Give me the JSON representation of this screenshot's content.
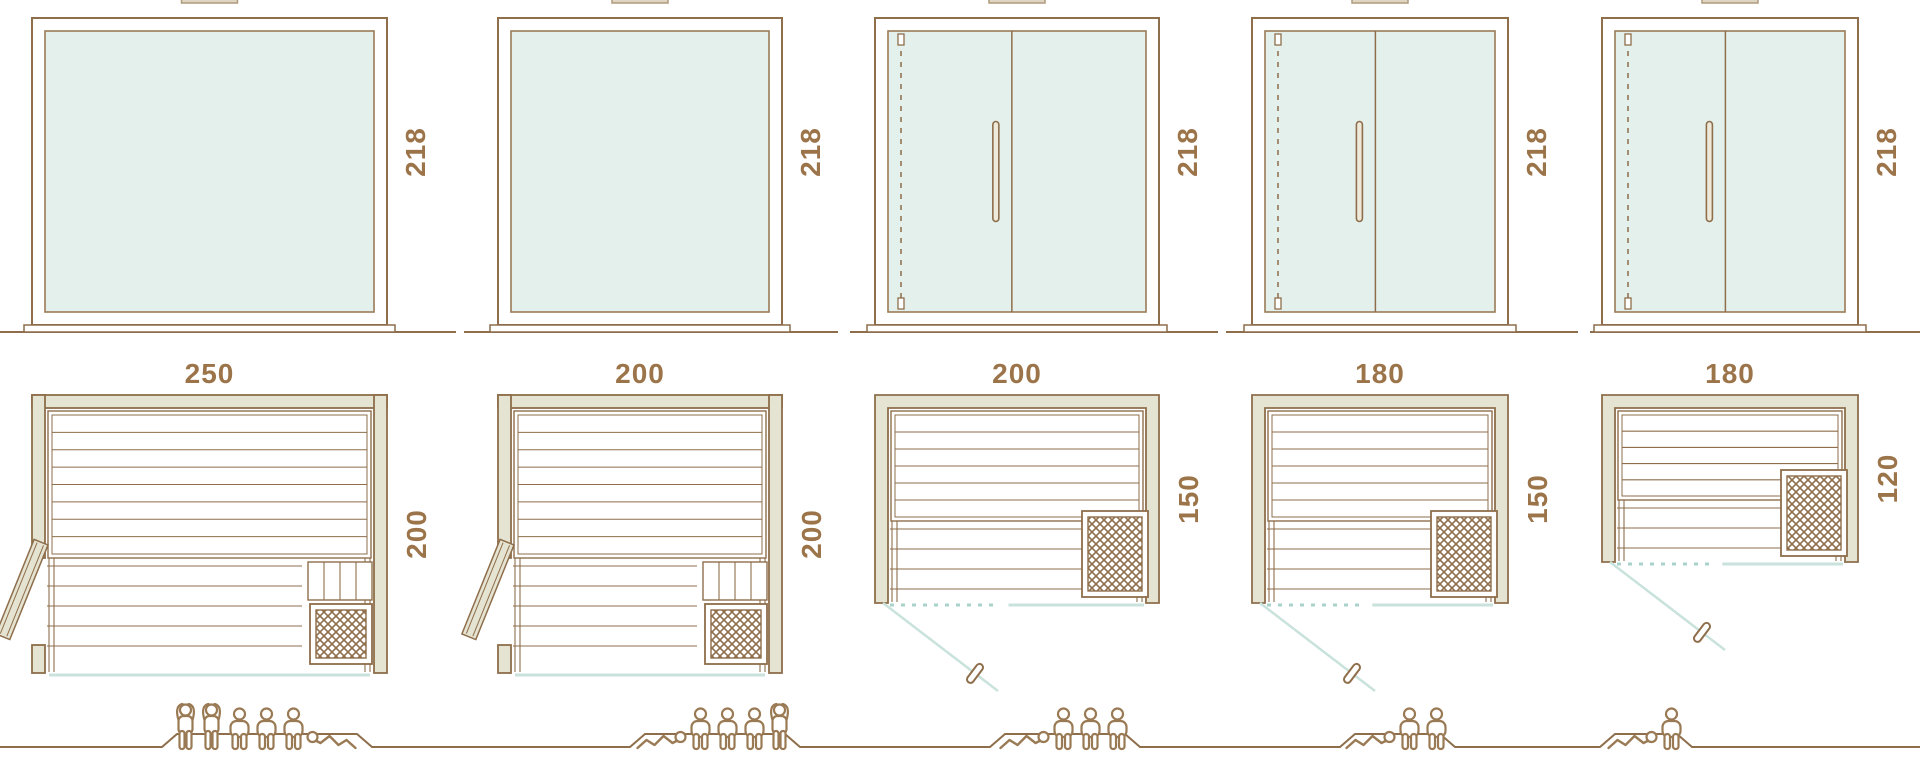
{
  "diagram_title": "sauna-size-comparison",
  "colors": {
    "line": "#8e6e4b",
    "text": "#9c744a",
    "glass_fill": "#e4f0ec",
    "glass_stroke": "#9b7b57",
    "wall_fill": "#e5e3d1",
    "teal_solid": "#c9e2dc",
    "teal_dash": "#a9d2cb",
    "people_line": "#9a7a54"
  },
  "models": [
    {
      "name": "sauna-250x200",
      "plan_width_label": "250",
      "plan_depth_label": "200",
      "elevation_height_label": "218",
      "front_type": "fixed-glass",
      "door": "hinged-side-door-left",
      "heater_position": "bottom-right",
      "capacity_total": 6,
      "capacity_icons": [
        "standing",
        "standing",
        "seated",
        "seated",
        "seated",
        "reclining"
      ]
    },
    {
      "name": "sauna-200x200",
      "plan_width_label": "200",
      "plan_depth_label": "200",
      "elevation_height_label": "218",
      "front_type": "fixed-glass",
      "door": "hinged-side-door-left",
      "heater_position": "bottom-right",
      "capacity_total": 5,
      "capacity_icons": [
        "reclining",
        "seated",
        "seated",
        "seated",
        "standing"
      ]
    },
    {
      "name": "sauna-200x150",
      "plan_width_label": "200",
      "plan_depth_label": "150",
      "elevation_height_label": "218",
      "front_type": "double-glass-door",
      "door": "front-glass-door",
      "heater_position": "bottom-right",
      "capacity_total": 4,
      "capacity_icons": [
        "reclining",
        "seated",
        "seated",
        "seated"
      ]
    },
    {
      "name": "sauna-180x150",
      "plan_width_label": "180",
      "plan_depth_label": "150",
      "elevation_height_label": "218",
      "front_type": "double-glass-door",
      "door": "front-glass-door",
      "heater_position": "bottom-right",
      "capacity_total": 3,
      "capacity_icons": [
        "reclining",
        "seated",
        "seated"
      ]
    },
    {
      "name": "sauna-180x120",
      "plan_width_label": "180",
      "plan_depth_label": "120",
      "elevation_height_label": "218",
      "front_type": "double-glass-door",
      "door": "front-glass-door",
      "heater_position": "right",
      "capacity_total": 2,
      "capacity_icons": [
        "reclining",
        "seated"
      ]
    }
  ]
}
